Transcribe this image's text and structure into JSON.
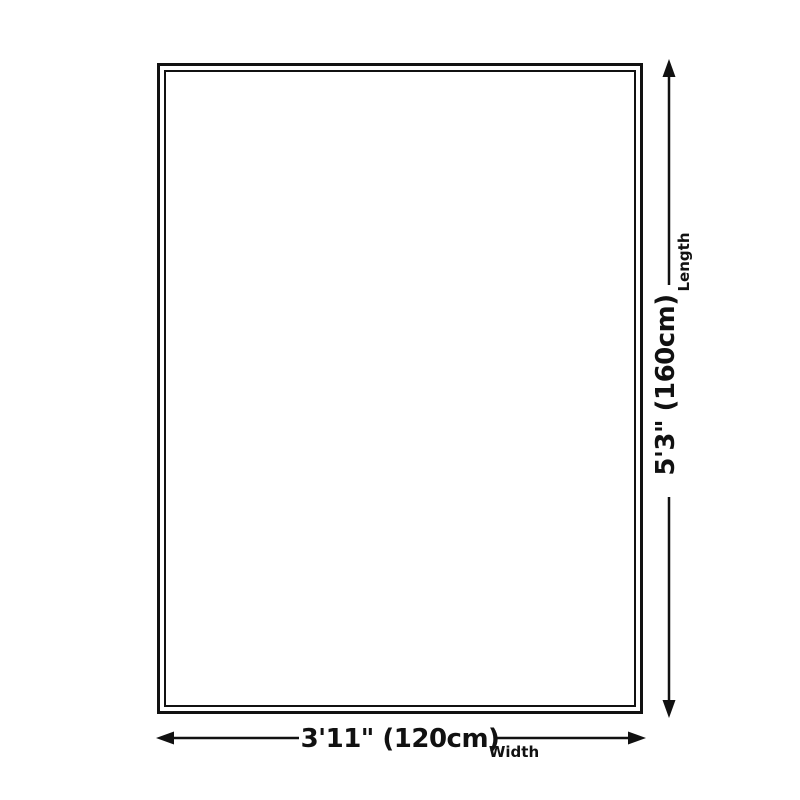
{
  "page": {
    "background": "#ffffff"
  },
  "colors": {
    "outline": "#111111",
    "annotation": "#111111",
    "text": "#111111"
  },
  "rug": {
    "shape": "rectangle-double-border"
  },
  "dimensions": {
    "length": {
      "value": "5'3\" (160cm)",
      "axis_label": "Length"
    },
    "width": {
      "value": "3'11\" (120cm)",
      "axis_label": "Width"
    }
  }
}
